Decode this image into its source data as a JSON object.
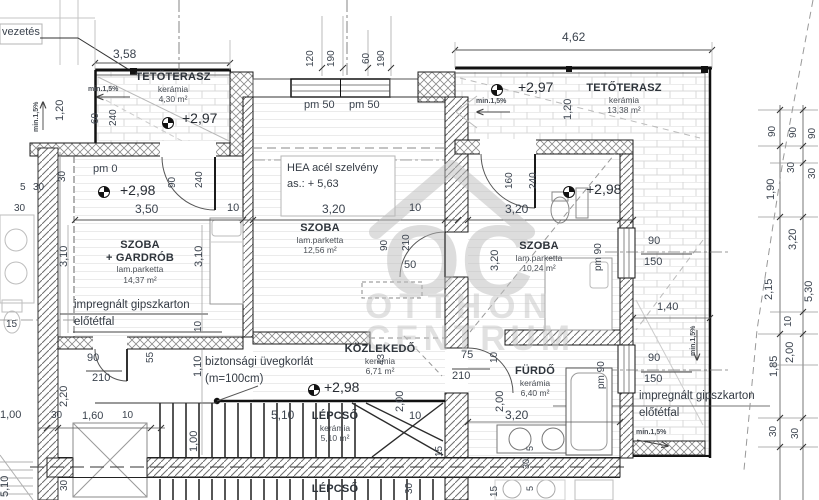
{
  "watermark": {
    "logo": "OC",
    "line1": "OTTHON",
    "line2": "CENTRUM"
  },
  "rooms": {
    "terrace_left": {
      "name": "TETŐTERASZ",
      "finish": "kerámia",
      "area": "4,30 m²"
    },
    "terrace_right": {
      "name": "TETŐTERASZ",
      "finish": "kerámia",
      "area": "13,38 m²"
    },
    "bedroom_left": {
      "name": "SZOBA",
      "name2": "+ GARDRÓB",
      "finish": "lam.parketta",
      "area": "14,37 m²"
    },
    "bedroom_mid": {
      "name": "SZOBA",
      "finish": "lam.parketta",
      "area": "12,56 m²"
    },
    "bedroom_right": {
      "name": "SZOBA",
      "finish": "lam.parketta",
      "area": "10,24 m²"
    },
    "hall": {
      "name": "KÖZLEKEDŐ",
      "finish": "kerámia",
      "area": "6,71 m²"
    },
    "bath": {
      "name": "FÜRDŐ",
      "finish": "kerámia",
      "area": "6,40 m²"
    },
    "stairs": {
      "name": "LÉPCSŐ",
      "finish": "kerámia",
      "area": "5,10 m²"
    },
    "stairs_lower": {
      "name": "LÉPCSŐ"
    }
  },
  "levels": {
    "terrace_left": "+2,97",
    "terrace_right": "+2,97",
    "bedroom_left_pm": "pm 0",
    "bedroom_left": "+2,98",
    "bedroom_right": "+2,98",
    "hall": "+2,98"
  },
  "annotations": {
    "beam_line1": "HEA acél szelvény",
    "beam_line2": "as.: + 5,63",
    "railing_line1": "biztonsági üvegkorlát",
    "railing_line2": "(m=100cm)",
    "lining_left_line1": "impregnált gipszkarton",
    "lining_left_line2": "előtétfal",
    "lining_right_line1": "impregnált gipszkarton",
    "lining_right_line2": "előtétfal",
    "duct": "vezetés",
    "window_mid_1": "pm 50",
    "window_mid_2": "pm 50",
    "window_right_1": "pm 90",
    "window_right_2": "pm 90"
  },
  "slopes": [
    "min.1,5%",
    "min.1,5%",
    "min.1,5%",
    "min.1,5%",
    "min.1,5%"
  ],
  "dims": {
    "top": [
      "3,58",
      "120",
      "190",
      "60",
      "190",
      "4,62"
    ],
    "terrace_left": [
      "1,20",
      "60",
      "240"
    ],
    "north": [
      "30",
      "90",
      "240",
      "5",
      "30",
      "30",
      "3,50",
      "10"
    ],
    "room_left": [
      "3,10",
      "3,10",
      "10",
      "15"
    ],
    "room_mid": [
      "3,20",
      "10",
      "90",
      "210",
      "50"
    ],
    "room_right": [
      "160",
      "240",
      "1,20",
      "3,20",
      "3,20"
    ],
    "right_wall": [
      "90",
      "150",
      "90",
      "150",
      "1,40"
    ],
    "hall": [
      "90",
      "210",
      "55",
      "1,10",
      "2,20",
      "1,00",
      "30",
      "1,60",
      "10",
      "43",
      "2,00",
      "10",
      "2,00"
    ],
    "stairs": [
      "5,10",
      "10",
      "1,00",
      "30",
      "5,10",
      "30",
      "15"
    ],
    "bath": [
      "75",
      "210",
      "3,20",
      "5",
      "30",
      "5",
      "15"
    ],
    "chain_a": [
      "90",
      "1,90",
      "2,15",
      "1,85",
      "30"
    ],
    "chain_b": [
      "90",
      "30",
      "3,20",
      "10",
      "2,00",
      "30"
    ],
    "chain_c": [
      "90",
      "30",
      "5,30"
    ]
  }
}
